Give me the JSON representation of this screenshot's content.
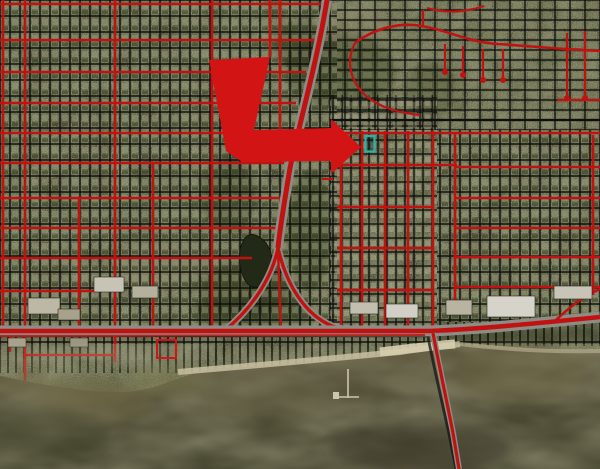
{
  "map": {
    "annotations": {
      "highlight_arrow": {
        "fill": "#d31414",
        "points": "209,60 270,57 254,130 331,128 331,119 361,147 331,174 331,161 242,162 226,151"
      },
      "selected_parcel": {
        "stroke": "#2ab3a7",
        "x": "365.5",
        "y": "136",
        "width": "9",
        "height": "15.5"
      },
      "flagged_parcel": {
        "stroke": "#d31414",
        "x": "157",
        "y": "340",
        "width": "19",
        "height": "18"
      }
    },
    "overlay_colors": {
      "street": "#c11212",
      "parcel_lines": "#0c0c0c",
      "road_casing": "#8d8d85"
    },
    "terrain_colors": {
      "land": "#4b4f32",
      "water": "#52503a",
      "beach": "#c9c0a1"
    }
  }
}
